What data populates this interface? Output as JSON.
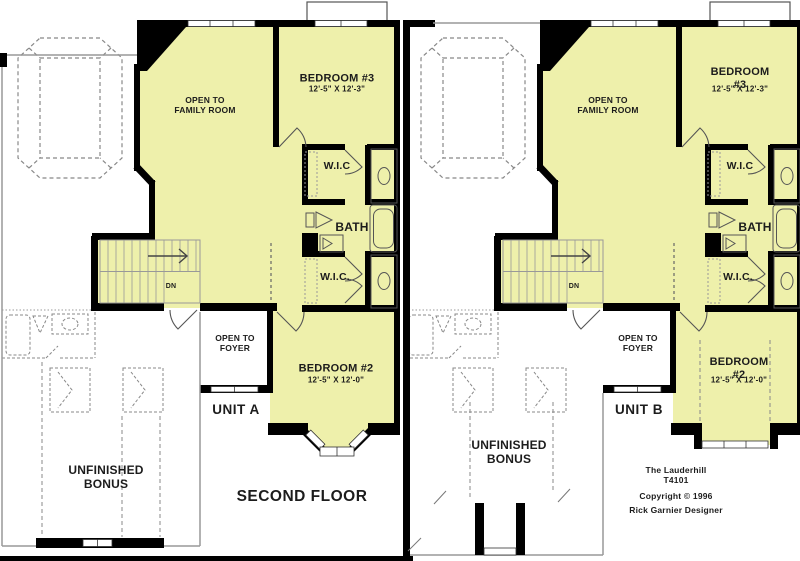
{
  "page": {
    "background": "#ffffff"
  },
  "colors": {
    "room_fill": "#eef0ab",
    "wall": "#000000",
    "outline_gray": "#999999",
    "dashed_gray": "#888888",
    "text": "#1c1c1c"
  },
  "floor": {
    "second_floor_label": "SECOND FLOOR"
  },
  "title_block": {
    "plan_name": "The Lauderhill",
    "plan_number": "T4101",
    "copyright": "Copyright  ©  1996",
    "designer": "Rick Garnier Designer"
  },
  "units": [
    {
      "id": "unit-a",
      "label": "UNIT A",
      "rooms": {
        "open_to_family_room": "OPEN TO\nFAMILY ROOM",
        "bedroom3_name": "BEDROOM #3",
        "bedroom3_dims": "12'-5\" X 12'-3\"",
        "wic_upper": "W.I.C",
        "bath": "BATH",
        "wic_lower": "W.I.C.",
        "stair_direction": "DN",
        "open_to_foyer": "OPEN TO\nFOYER",
        "bedroom2_name": "BEDROOM #2",
        "bedroom2_dims": "12'-5\" X 12'-0\"",
        "bonus": "UNFINISHED\nBONUS"
      }
    },
    {
      "id": "unit-b",
      "label": "UNIT B",
      "rooms": {
        "open_to_family_room": "OPEN TO\nFAMILY ROOM",
        "bedroom3_name": "BEDROOM #3",
        "bedroom3_dims": "12'-5\" X 12'-3\"",
        "wic_upper": "W.I.C",
        "bath": "BATH",
        "wic_lower": "W.I.C.",
        "stair_direction": "DN",
        "open_to_foyer": "OPEN TO\nFOYER",
        "bedroom2_name": "BEDROOM #2",
        "bedroom2_dims": "12'-5\" X 12'-0\"",
        "bonus": "UNFINISHED\nBONUS"
      }
    }
  ]
}
